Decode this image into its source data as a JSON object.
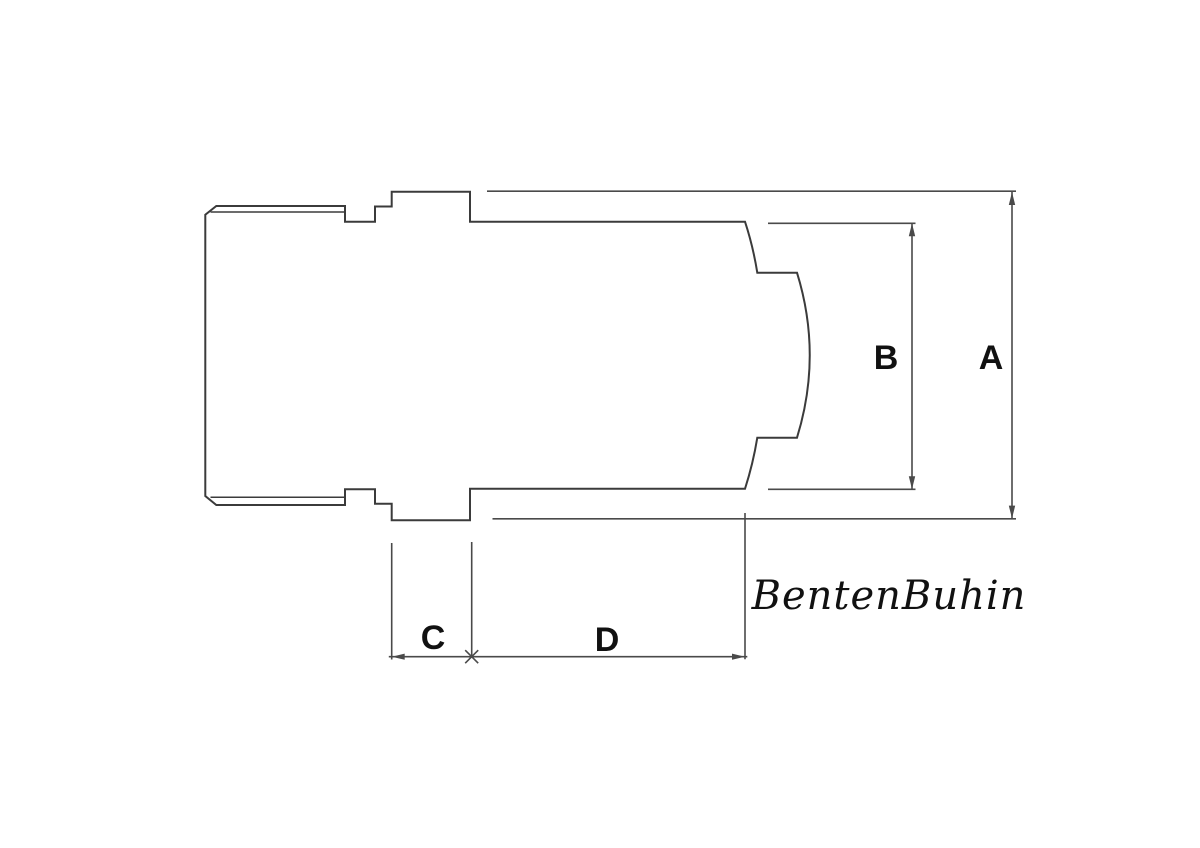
{
  "drawing": {
    "dimension_labels": {
      "a": "A",
      "b": "B",
      "c": "C",
      "d": "D"
    },
    "signature": "BentenBuhin",
    "colors": {
      "bg": "#ffffff",
      "line": "#3b3b3b",
      "dim": "#4a4a4a",
      "label": "#111111"
    }
  }
}
